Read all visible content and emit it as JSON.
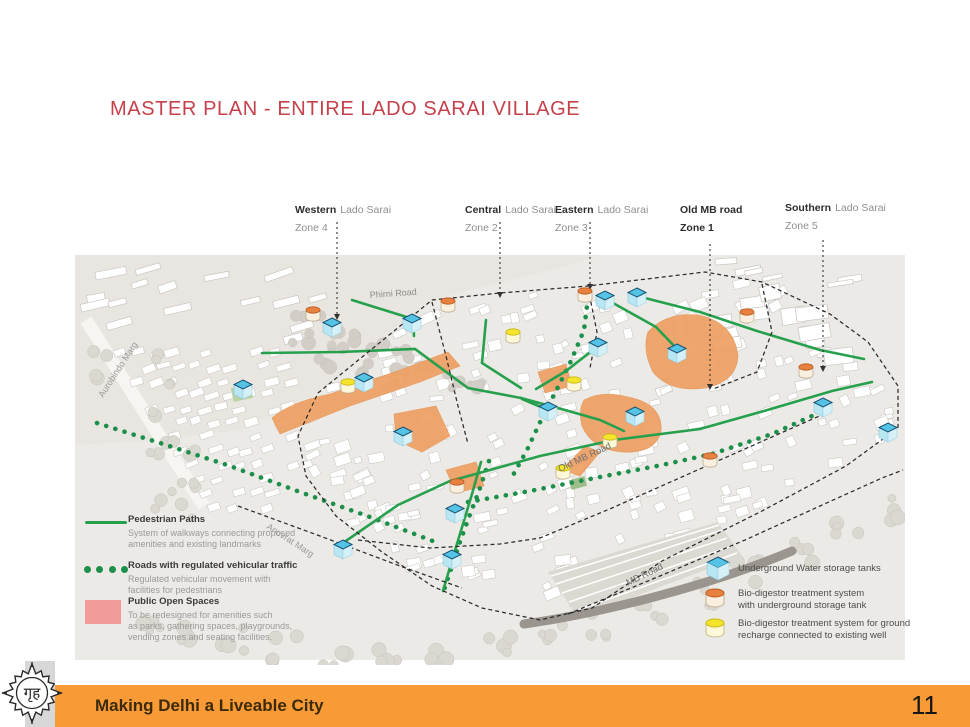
{
  "title": "MASTER PLAN - ENTIRE LADO SARAI VILLAGE",
  "zones": [
    {
      "name": "Western",
      "rest": "Lado Sarai",
      "zone": "Zone 4"
    },
    {
      "name": "Central",
      "rest": "Lado Sarai",
      "zone": "Zone 2"
    },
    {
      "name": "Eastern",
      "rest": "Lado Sarai",
      "zone": "Zone 3"
    },
    {
      "name": "Old MB road",
      "rest": "",
      "zone": "Zone 1"
    },
    {
      "name": "Southern",
      "rest": "Lado Sarai",
      "zone": "Zone 5"
    }
  ],
  "map_labels": {
    "phirni": "Phirni Road",
    "aurobindo": "Aurobindo Marg",
    "anuvrat": "Anuvrat Marg",
    "old_mb": "Old MB Road",
    "mb": "MB Road"
  },
  "legend_left": [
    {
      "title": "Pedestrian Paths",
      "desc": "System of walkways connecting proposed\namenities and existing landmarks"
    },
    {
      "title": "Roads with regulated vehicular traffic",
      "desc": "Regulated vehicular movement with\nfacilities for pedestrians"
    },
    {
      "title": "Public Open Spaces",
      "desc": "To be redesigned for amenities such\nas parks, gathering spaces, playgrounds,\nvending zones and seating facilities."
    }
  ],
  "legend_right": [
    {
      "label": "Underground Water storage tanks"
    },
    {
      "label": "Bio-digestor treatment system\nwith underground storage tank"
    },
    {
      "label": "Bio-digestor treatment system for ground\nrecharge connected to existing well"
    }
  ],
  "footer": {
    "text": "Making Delhi a Liveable City",
    "page": "11"
  },
  "logo_text": "गृह",
  "colors": {
    "title": "#c5414b",
    "footer_bar": "#f89b37",
    "path_green": "#27a04e",
    "dot_green": "#1c8f4a",
    "open_space": "#efa063",
    "legend_pink": "#f29b9b",
    "tank_blue": "#54c3e6",
    "bio_orange": "#e8813f",
    "bio_yellow": "#f4e52c",
    "boundary": "#2b2b2b"
  },
  "markers": {
    "water_tanks": [
      [
        243,
        386
      ],
      [
        332,
        324
      ],
      [
        412,
        320
      ],
      [
        364,
        379
      ],
      [
        403,
        433
      ],
      [
        343,
        546
      ],
      [
        452,
        556
      ],
      [
        455,
        510
      ],
      [
        605,
        297
      ],
      [
        637,
        294
      ],
      [
        598,
        344
      ],
      [
        548,
        408
      ],
      [
        635,
        413
      ],
      [
        677,
        350
      ],
      [
        823,
        404
      ],
      [
        888,
        429
      ]
    ],
    "bio_orange": [
      [
        313,
        310
      ],
      [
        448,
        301
      ],
      [
        585,
        291
      ],
      [
        747,
        312
      ],
      [
        806,
        367
      ],
      [
        710,
        456
      ],
      [
        457,
        482
      ]
    ],
    "bio_yellow": [
      [
        348,
        382
      ],
      [
        513,
        332
      ],
      [
        574,
        380
      ],
      [
        563,
        468
      ],
      [
        610,
        437
      ]
    ]
  }
}
